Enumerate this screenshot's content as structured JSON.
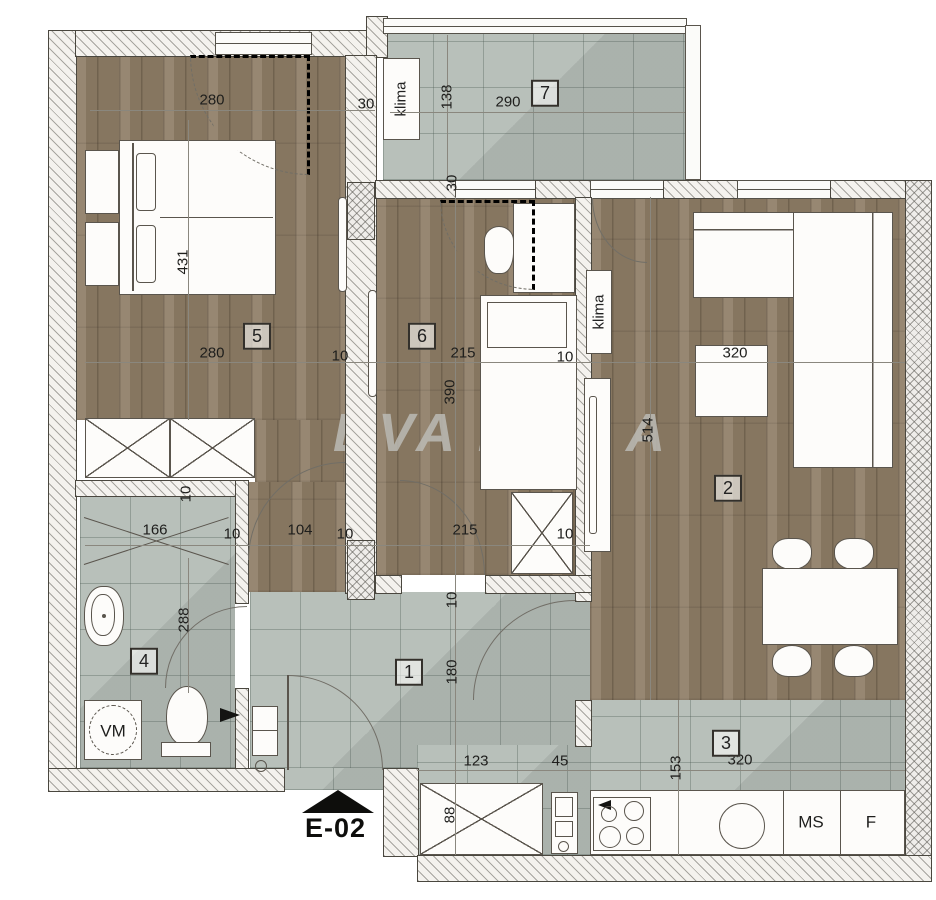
{
  "watermark": {
    "left": "DVA ZV",
    "right": "A"
  },
  "entrance": {
    "label": "E-02"
  },
  "equipment_labels": {
    "klima_balcony": "klima",
    "klima_living": "klima",
    "washing_machine": "VM",
    "dishwasher": "MS",
    "fridge": "F"
  },
  "room_labels": [
    {
      "num": "5",
      "x": 257,
      "y": 336
    },
    {
      "num": "6",
      "x": 422,
      "y": 336
    },
    {
      "num": "7",
      "x": 545,
      "y": 93
    },
    {
      "num": "2",
      "x": 728,
      "y": 488
    },
    {
      "num": "1",
      "x": 409,
      "y": 672
    },
    {
      "num": "3",
      "x": 726,
      "y": 743
    },
    {
      "num": "4",
      "x": 144,
      "y": 661
    }
  ],
  "dimension_labels": [
    {
      "text": "280",
      "x": 212,
      "y": 100,
      "rot": false
    },
    {
      "text": "30",
      "x": 366,
      "y": 104,
      "rot": false
    },
    {
      "text": "138",
      "x": 447,
      "y": 97,
      "rot": true
    },
    {
      "text": "290",
      "x": 508,
      "y": 102,
      "rot": false
    },
    {
      "text": "431",
      "x": 183,
      "y": 262,
      "rot": true
    },
    {
      "text": "280",
      "x": 212,
      "y": 353,
      "rot": false
    },
    {
      "text": "10",
      "x": 340,
      "y": 356,
      "rot": false
    },
    {
      "text": "215",
      "x": 463,
      "y": 353,
      "rot": false
    },
    {
      "text": "10",
      "x": 565,
      "y": 357,
      "rot": false
    },
    {
      "text": "320",
      "x": 735,
      "y": 353,
      "rot": false
    },
    {
      "text": "30",
      "x": 452,
      "y": 183,
      "rot": true
    },
    {
      "text": "390",
      "x": 450,
      "y": 392,
      "rot": true
    },
    {
      "text": "514",
      "x": 648,
      "y": 430,
      "rot": true
    },
    {
      "text": "166",
      "x": 155,
      "y": 530,
      "rot": false
    },
    {
      "text": "10",
      "x": 232,
      "y": 534,
      "rot": false
    },
    {
      "text": "104",
      "x": 300,
      "y": 530,
      "rot": false
    },
    {
      "text": "10",
      "x": 345,
      "y": 534,
      "rot": false
    },
    {
      "text": "215",
      "x": 465,
      "y": 530,
      "rot": false
    },
    {
      "text": "10",
      "x": 565,
      "y": 534,
      "rot": false
    },
    {
      "text": "10",
      "x": 186,
      "y": 494,
      "rot": true
    },
    {
      "text": "288",
      "x": 184,
      "y": 620,
      "rot": true
    },
    {
      "text": "10",
      "x": 452,
      "y": 600,
      "rot": true
    },
    {
      "text": "180",
      "x": 452,
      "y": 672,
      "rot": true
    },
    {
      "text": "123",
      "x": 476,
      "y": 761,
      "rot": false
    },
    {
      "text": "45",
      "x": 560,
      "y": 761,
      "rot": false
    },
    {
      "text": "88",
      "x": 450,
      "y": 815,
      "rot": true
    },
    {
      "text": "320",
      "x": 740,
      "y": 760,
      "rot": false
    },
    {
      "text": "153",
      "x": 676,
      "y": 768,
      "rot": true
    }
  ]
}
